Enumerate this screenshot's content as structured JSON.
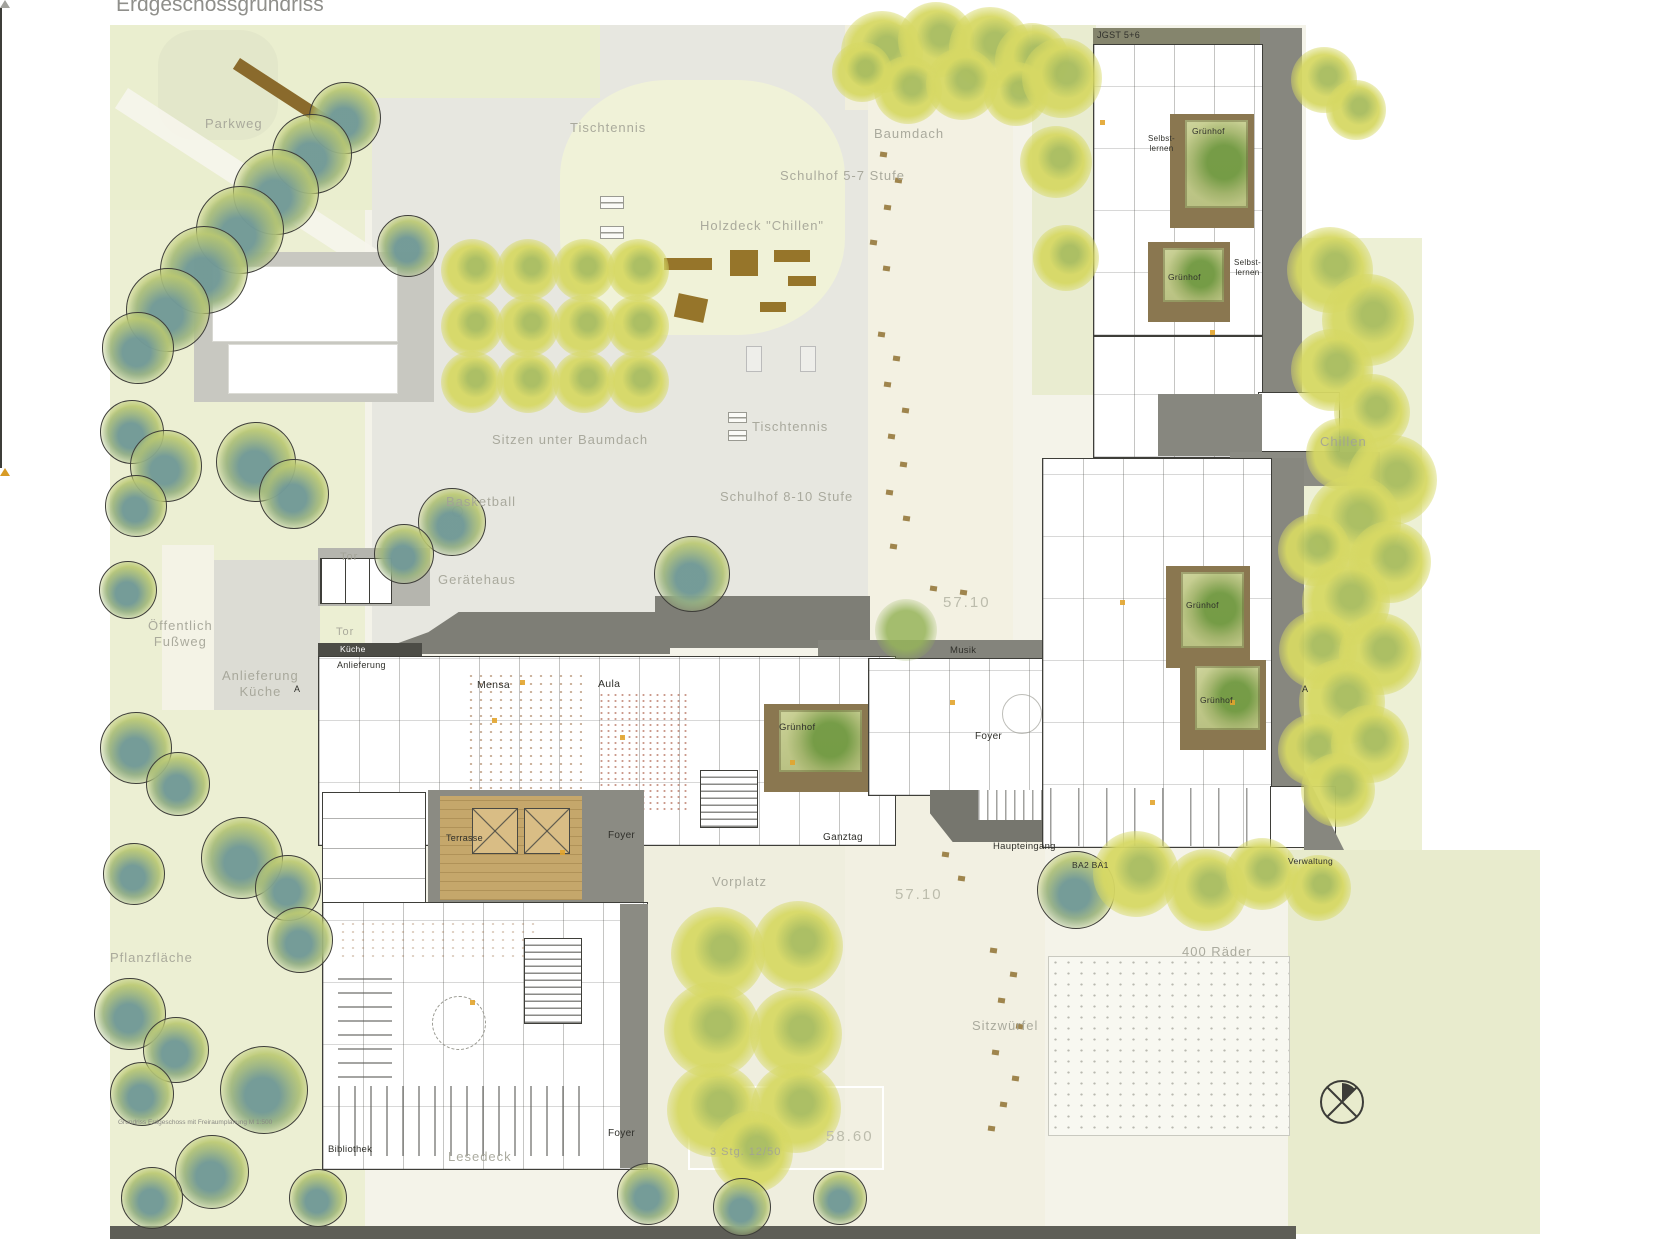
{
  "title": "Erdgeschossgrundriss",
  "caption": "Grundriss Erdgeschoss mit Freiraumplanung M 1:500",
  "site_labels": {
    "parkweg": "Parkweg",
    "tischtennis": "Tischtennis",
    "schulhof_5_7": "Schulhof 5-7 Stufe",
    "holzdeck_chillen": "Holzdeck \"Chillen\"",
    "baumdach": "Baumdach",
    "sitzen_unter_baumdach": "Sitzen unter Baumdach",
    "basketball": "Basketball",
    "schulhof_8_10": "Schulhof 8-10 Stufe",
    "geraetehaus": "Gerätehaus",
    "tor": "Tor",
    "oeffentlich_fussweg": "Öffentlich\nFußweg",
    "anlieferung_kueche": "Anlieferung\nKüche",
    "vorplatz": "Vorplatz",
    "pflanzflaeche": "Pflanzfläche",
    "sitzwuerfel": "Sitzwürfel",
    "raeder": "400 Räder",
    "chillen": "Chillen",
    "lesedeck": "Lesedeck",
    "treppe": "3 Stg. 12/50",
    "level_57_10": "57.10",
    "level_58_60": "58.60"
  },
  "room_labels": {
    "kueche": "Küche",
    "anlieferung": "Anlieferung",
    "mensa": "Mensa",
    "aula": "Aula",
    "gruenhof": "Grünhof",
    "foyer": "Foyer",
    "ganztag": "Ganztag",
    "musik": "Musik",
    "haupteingang": "Haupteingang",
    "bauabschnitte": "BA2 BA1",
    "verwaltung": "Verwaltung",
    "jgst_5_6": "JGST 5+6",
    "selbstlernen": "Selbst-\nlernen",
    "bibliothek": "Bibliothek",
    "terrasse": "Terrasse",
    "section_marker": "A"
  },
  "colors": {
    "park_green": "#ecefd3",
    "schoolyard_grey": "#e7e7e0",
    "plaza_cream": "#f3f1e2",
    "roof_dark": "#7e7e76",
    "building_outline": "#3e3e39",
    "courtyard_frame": "#8a7750",
    "courtyard_green": "#68943a",
    "tree_yellow": "#d6d864",
    "tree_blue": "#608ea0",
    "wood_deck": "#c5a76b",
    "bench_brown": "#96752a",
    "accent_orange": "#e2a42c"
  }
}
